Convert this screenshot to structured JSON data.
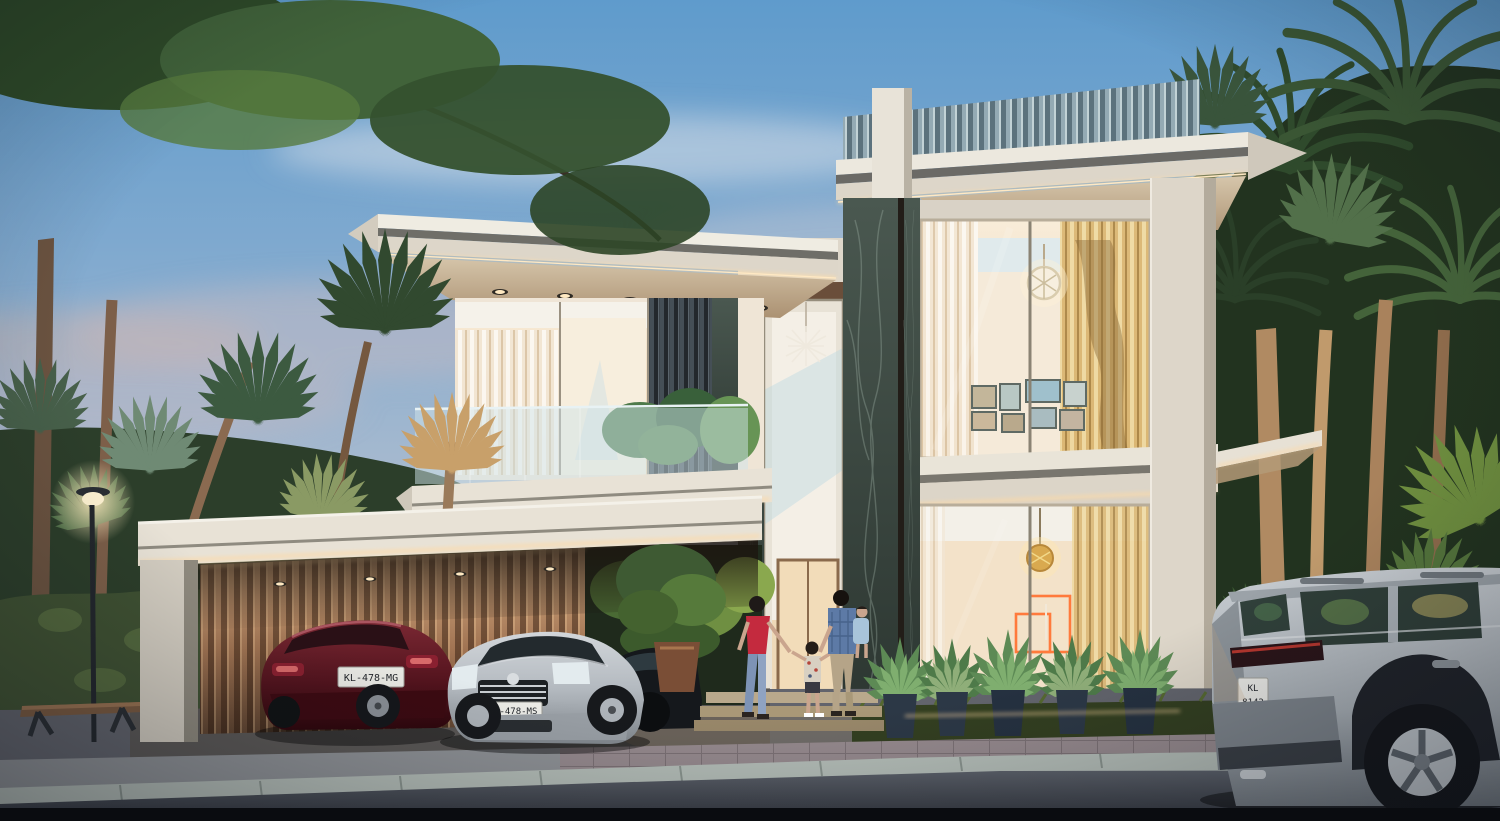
{
  "scene": {
    "description": "Twilight 3D architectural rendering of a modern two-storey luxury villa with floor-to-ceiling glazing, dark marble piers, warm LED strip lighting, a slatted carport with parked cars, tropical palm landscaping and a family walking to the lit entrance",
    "time_of_day": "dusk",
    "style": "contemporary tropical modern villa",
    "sky": {
      "top_color": "#5f9bcc",
      "mid_color": "#9db7d2",
      "horizon_color": "#d8ccc3",
      "clouds": "soft pink-grey wisps"
    },
    "architecture": {
      "storeys": 2,
      "roof_slat_screen_color": "#94aab4",
      "wall_color": "#e5dfd3",
      "marble_color": "#3f4c45",
      "led_accent_color": "#ffd9a3",
      "neon_artwork_color": "#ff7a3c",
      "features": [
        "vertical slat roof parapet screen",
        "cantilevered flat roofs with recessed downlights",
        "double-height glass entrance with sputnik chandelier",
        "glass balcony with planters",
        "geometric pendant light upstairs",
        "gallery wall of framed pictures",
        "gold orb pendant on ground floor",
        "orange neon wall artwork",
        "bronze slatted carport wall"
      ]
    },
    "vehicles": [
      {
        "name": "dark-red-hatchback",
        "plate": "KL-478-MG",
        "body_color": "#5a1822",
        "position": "under carport, left"
      },
      {
        "name": "silver-sedan",
        "plate": "KL-478-MS",
        "body_color": "#b9bec3",
        "position": "under carport, right"
      },
      {
        "name": "black-car",
        "plate": "",
        "body_color": "#15181c",
        "position": "near entrance, partly hidden"
      },
      {
        "name": "silver-suv",
        "plate_top": "KL",
        "plate_bottom": "8142",
        "body_color": "#b6bcc1",
        "position": "street foreground, right"
      }
    ],
    "people": {
      "count": 4,
      "group": [
        {
          "name": "woman",
          "clothing": "red top, blue jeans, dark hair"
        },
        {
          "name": "boy",
          "clothing": "patterned shirt, dark shorts"
        },
        {
          "name": "man",
          "clothing": "blue shirt, khaki trousers"
        },
        {
          "name": "toddler",
          "clothing": "light blue, carried by man"
        }
      ]
    },
    "landscape": {
      "palm_trees": "fan palms left, date palms right, warm uplighting on trunks",
      "hedge": "ivy hedge behind bench",
      "street_lamp_count": 1,
      "bench_count": 1,
      "potted_plants_count": 5,
      "grass_strip": true
    },
    "ground": {
      "asphalt": "#42464f",
      "curb": "#b5beb8",
      "pavers": "#968a8e",
      "grass": "#333f20"
    }
  }
}
